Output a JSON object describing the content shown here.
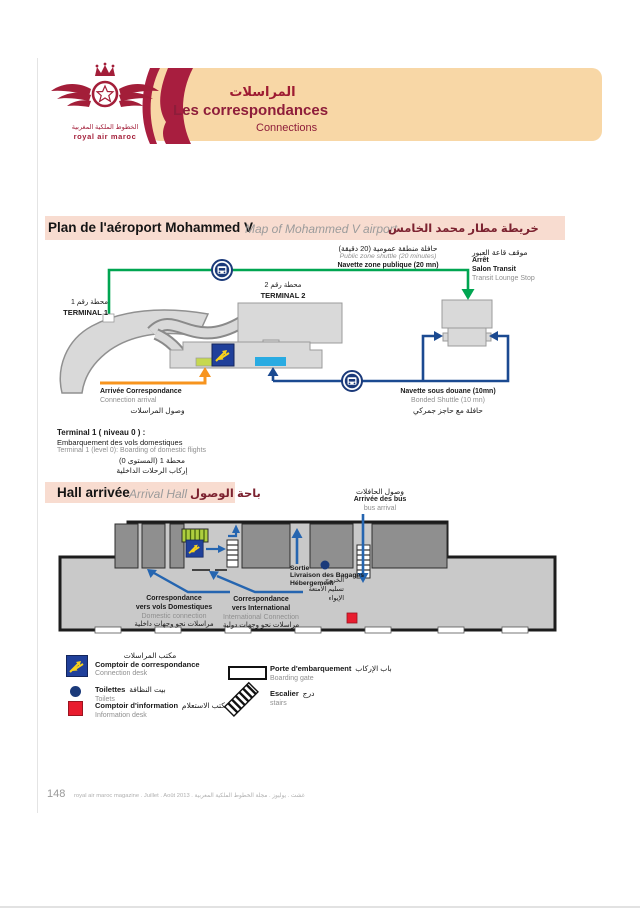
{
  "page": {
    "number": "148",
    "footer_text": "royal air maroc magazine . Juillet . Août 2013 . غشت . يوليوز . مجلة الخطوط الملكية المغربية"
  },
  "header": {
    "logo": {
      "brand_ar": "الخطوط الملكية المغربية",
      "brand_en": "royal air maroc"
    },
    "title_ar": "المراسلات",
    "title_fr": "Les correspondances",
    "title_en": "Connections"
  },
  "airport_map": {
    "title_fr": "Plan de l'aéroport Mohammed V",
    "title_en": "Map of Mohammed V airport",
    "title_ar": "خريطة مطار محمد الخامس",
    "public_shuttle": {
      "ar": "حافلة منطقة عمومية (20 دقيقة)",
      "en": "Public zone shuttle (20 minutes)",
      "fr": "Navette zone publique (20 mn)"
    },
    "transit_stop": {
      "ar": "موقف قاعة العبور",
      "fr_line1": "Arrêt",
      "fr_line2": "Salon Transit",
      "en": "Transit Lounge Stop"
    },
    "terminal1": {
      "ar": "محطة رقم 1",
      "name": "TERMINAL 1"
    },
    "terminal2": {
      "ar": "محطة رقم 2",
      "name": "TERMINAL 2"
    },
    "connection_arrival": {
      "fr": "Arrivée Correspondance",
      "en": "Connection arrival",
      "ar": "وصول المراسلات"
    },
    "bonded_shuttle": {
      "fr": "Navette sous douane (10mn)",
      "en": "Bonded Shuttle (10 mn)",
      "ar": "حافلة مع حاجز جمركي"
    },
    "terminal1_note": {
      "fr_title": "Terminal 1 ( niveau 0 ) :",
      "fr": "Embarquement des vols domestiques",
      "en": "Terminal 1 (level 0): Boarding of domestic flights",
      "ar_line1": "محطة 1 (المستوى 0)",
      "ar_line2": "إركاب الرحلات الداخلية"
    }
  },
  "arrival_hall": {
    "title_fr": "Hall arrivée",
    "title_en": "Arrival Hall",
    "title_ar": "باحة الوصول",
    "bus_arrival": {
      "ar": "وصول الحافلات",
      "fr": "Arrivée des bus",
      "en": "bus arrival"
    },
    "exit_block": {
      "fr_line1": "Sortie",
      "fr_line2": "Livraison des Bagages",
      "fr_line3": "Hébergement",
      "ar_line1": "الخروج",
      "ar_line2": "تسليم الأمتعة",
      "ar_line3": "الإيواء"
    },
    "domestic": {
      "fr_line1": "Correspondance",
      "fr_line2": "vers vols Domestiques",
      "en": "Domestic connection",
      "ar": "مراسلات نحو وجهات داخلية"
    },
    "international": {
      "fr_line1": "Correspondance",
      "fr_line2": "vers International",
      "en": "International Connection",
      "ar": "مراسلات نحو وجهات دولية"
    }
  },
  "legend": {
    "connection_desk": {
      "ar": "مكتب المراسلات",
      "fr": "Comptoir de correspondance",
      "en": "Connection desk"
    },
    "toilets": {
      "fr": "Toilettes",
      "ar": "بيت النظافة",
      "en": "Toilets"
    },
    "information": {
      "fr": "Comptoir d'information",
      "ar": "مكتب الاستعلام",
      "en": "Information desk"
    },
    "boarding_gate": {
      "fr": "Porte d'embarquement",
      "ar": "باب الإركاب",
      "en": "Boarding gate"
    },
    "stairs": {
      "fr": "Escalier",
      "ar": "درج",
      "en": "stairs"
    }
  },
  "colors": {
    "brand_crimson": "#a31e39",
    "banner_peach": "#f8d7a6",
    "section_band_pink": "#f8dcd0",
    "route_green": "#00a551",
    "route_blue": "#1b4a91",
    "arrow_orange": "#f7941e",
    "desk_blue": "#20409a",
    "desk_yellow": "#f8d21c",
    "highlight_cyan": "#29abe2",
    "highlight_lime": "#c6d850",
    "info_red": "#e81c2e",
    "building_gray": "#d9d9d9",
    "hall_gray": "#c9c9c9",
    "block_gray": "#8f8f8f"
  }
}
